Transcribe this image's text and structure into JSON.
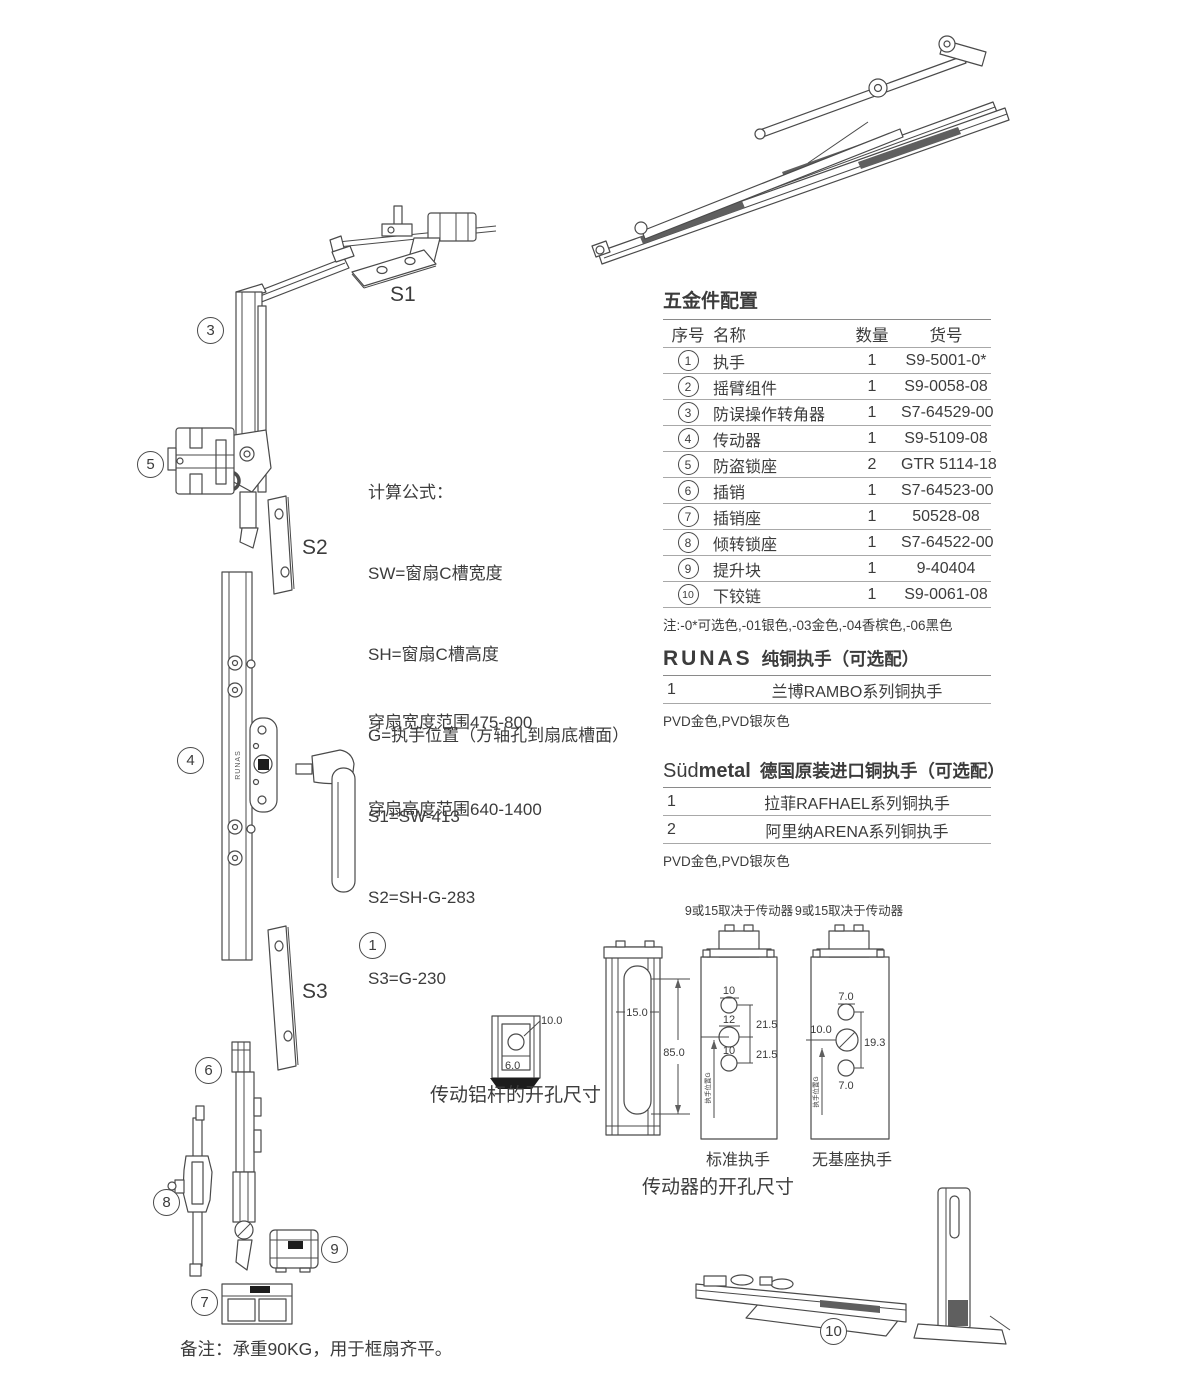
{
  "colors": {
    "ink": "#3c3c3c",
    "line": "#4a4a4a",
    "table_line": "#a8a8a8"
  },
  "callouts": {
    "c1": "1",
    "c3": "3",
    "c4": "4",
    "c5": "5",
    "c6": "6",
    "c7": "7",
    "c8": "8",
    "c9": "9",
    "c10": "10"
  },
  "plate_labels": {
    "s1": "S1",
    "s2": "S2",
    "s3": "S3"
  },
  "bar_brand": "RUNAS",
  "formulas": {
    "title": "计算公式：",
    "l1": "SW=窗扇C槽宽度",
    "l2": "SH=窗扇C槽高度",
    "l3": "G=执手位置（方轴孔到扇底槽面）",
    "l4": "S1=SW-413",
    "l5": "S2=SH-G-283",
    "l6": "S3=G-230"
  },
  "sash_range": {
    "line1": "穿扇宽度范围475-800",
    "line2": "穿扇高度范围640-1400"
  },
  "parts_table": {
    "title": "五金件配置",
    "headers": [
      "序号",
      "名称",
      "数量",
      "货号"
    ],
    "rows": [
      {
        "no": "1",
        "name": "执手",
        "qty": "1",
        "code": "S9-5001-0*"
      },
      {
        "no": "2",
        "name": "摇臂组件",
        "qty": "1",
        "code": "S9-0058-08"
      },
      {
        "no": "3",
        "name": "防误操作转角器",
        "qty": "1",
        "code": "S7-64529-00"
      },
      {
        "no": "4",
        "name": "传动器",
        "qty": "1",
        "code": "S9-5109-08"
      },
      {
        "no": "5",
        "name": "防盗锁座",
        "qty": "2",
        "code": "GTR 5114-18"
      },
      {
        "no": "6",
        "name": "插销",
        "qty": "1",
        "code": "S7-64523-00"
      },
      {
        "no": "7",
        "name": "插销座",
        "qty": "1",
        "code": "50528-08"
      },
      {
        "no": "8",
        "name": "倾转锁座",
        "qty": "1",
        "code": "S7-64522-00"
      },
      {
        "no": "9",
        "name": "提升块",
        "qty": "1",
        "code": "9-40404"
      },
      {
        "no": "10",
        "name": "下铰链",
        "qty": "1",
        "code": "S9-0061-08"
      }
    ],
    "note": "注:-0*可选色,-01银色,-03金色,-04香槟色,-06黑色"
  },
  "runas_section": {
    "brand": "RUNAS",
    "title": "纯铜执手（可选配）",
    "row_no": "1",
    "row_name": "兰博RAMBO系列铜执手",
    "note": "PVD金色,PVD银灰色"
  },
  "sudmetal_section": {
    "brand_regular": "Süd",
    "brand_bold": "metal",
    "title": "德国原装进口铜执手（可选配）",
    "rows": [
      {
        "no": "1",
        "name": "拉菲RAFHAEL系列铜执手"
      },
      {
        "no": "2",
        "name": "阿里纳ARENA系列铜执手"
      }
    ],
    "note": "PVD金色,PVD银灰色"
  },
  "drawings": {
    "alu_rod": {
      "caption": "传动铝杆的开孔尺寸",
      "dim_top": "10.0",
      "dim_bottom": "6.0"
    },
    "driver_caption": "传动器的开孔尺寸",
    "profile": {
      "slot_width": "15.0",
      "slot_height": "85.0"
    },
    "standard": {
      "header": "9或15取决于传动器",
      "caption": "标准执手",
      "dim_top": "10",
      "dim_mid": "12",
      "dim_bot": "10",
      "span_top": "21.5",
      "span_bot": "21.5",
      "side_label": "执手位置G"
    },
    "no_base": {
      "header": "9或15取决于传动器",
      "caption": "无基座执手",
      "dim_top": "7.0",
      "dim_left": "10.0",
      "dim_right": "19.3",
      "dim_bot": "7.0",
      "side_label": "执手位置G"
    }
  },
  "footnote": "备注：承重90KG，用于框扇齐平。"
}
